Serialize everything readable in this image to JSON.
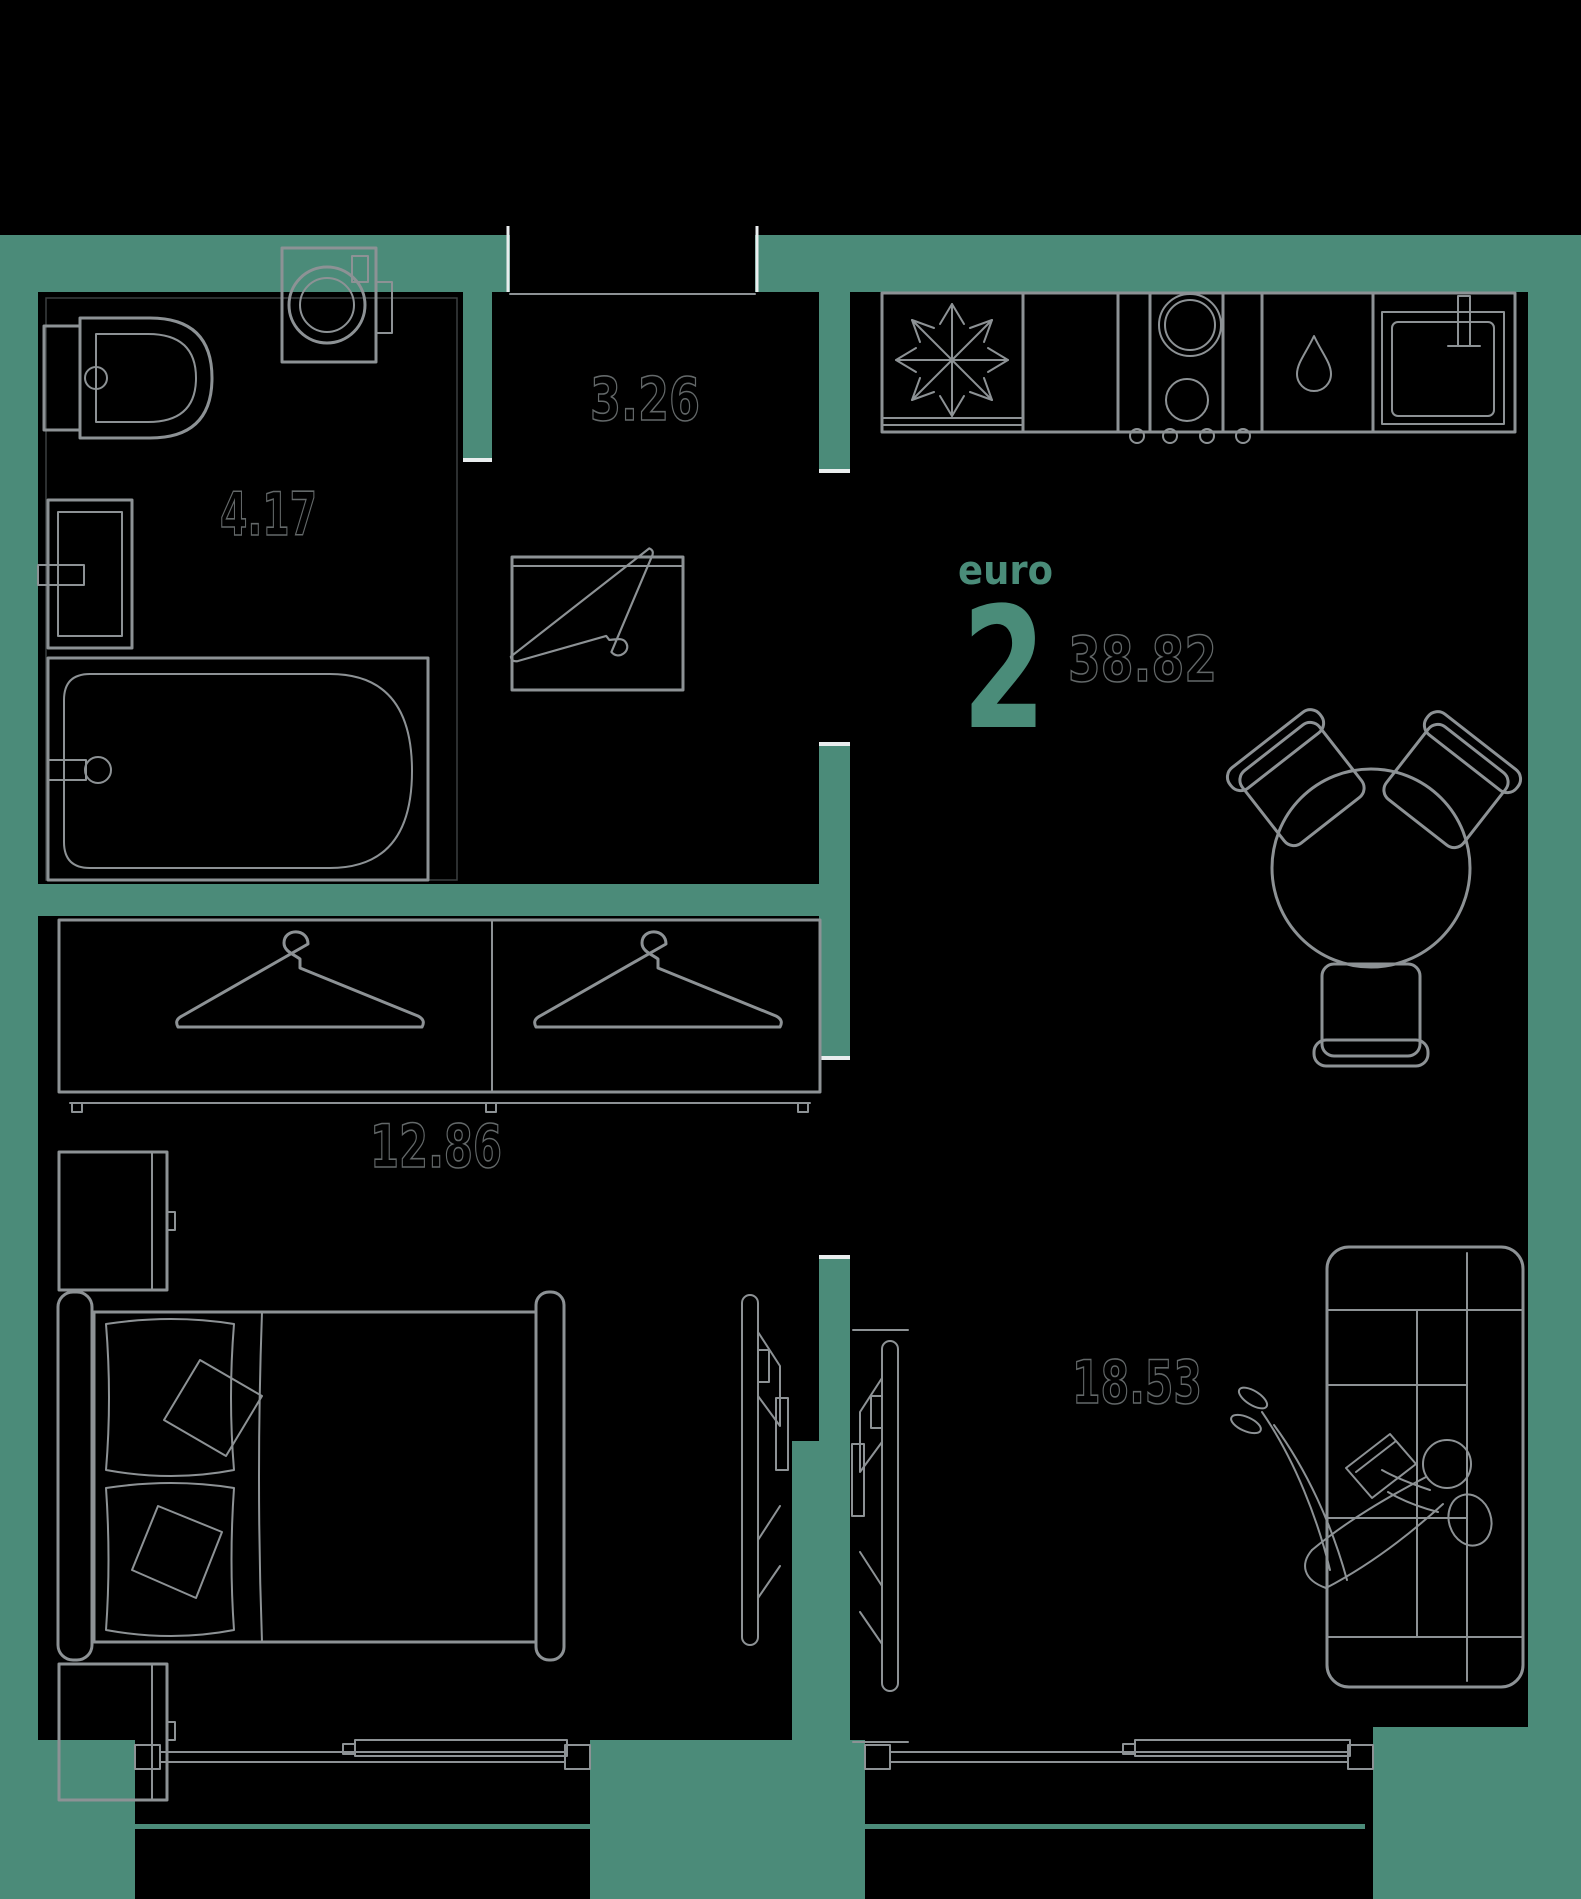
{
  "floorplan": {
    "layout_type_label": "euro",
    "room_count": "2",
    "total_area": "38.82",
    "rooms": [
      {
        "name": "hallway",
        "area": "3.26"
      },
      {
        "name": "bathroom",
        "area": "4.17"
      },
      {
        "name": "bedroom",
        "area": "12.86"
      },
      {
        "name": "living-kitchen",
        "area": "18.53"
      }
    ],
    "colors": {
      "background": "#000000",
      "wall": "#4b8b79",
      "furniture_line": "#8d9295",
      "area_label_outline": "#636869",
      "accent": "#4a8c79",
      "door_jamb": "#e9edee"
    },
    "icons": [
      "snowflake-icon",
      "water-drop-icon",
      "clothes-hanger-icon",
      "person-relaxing-icon",
      "burner-icon"
    ]
  }
}
